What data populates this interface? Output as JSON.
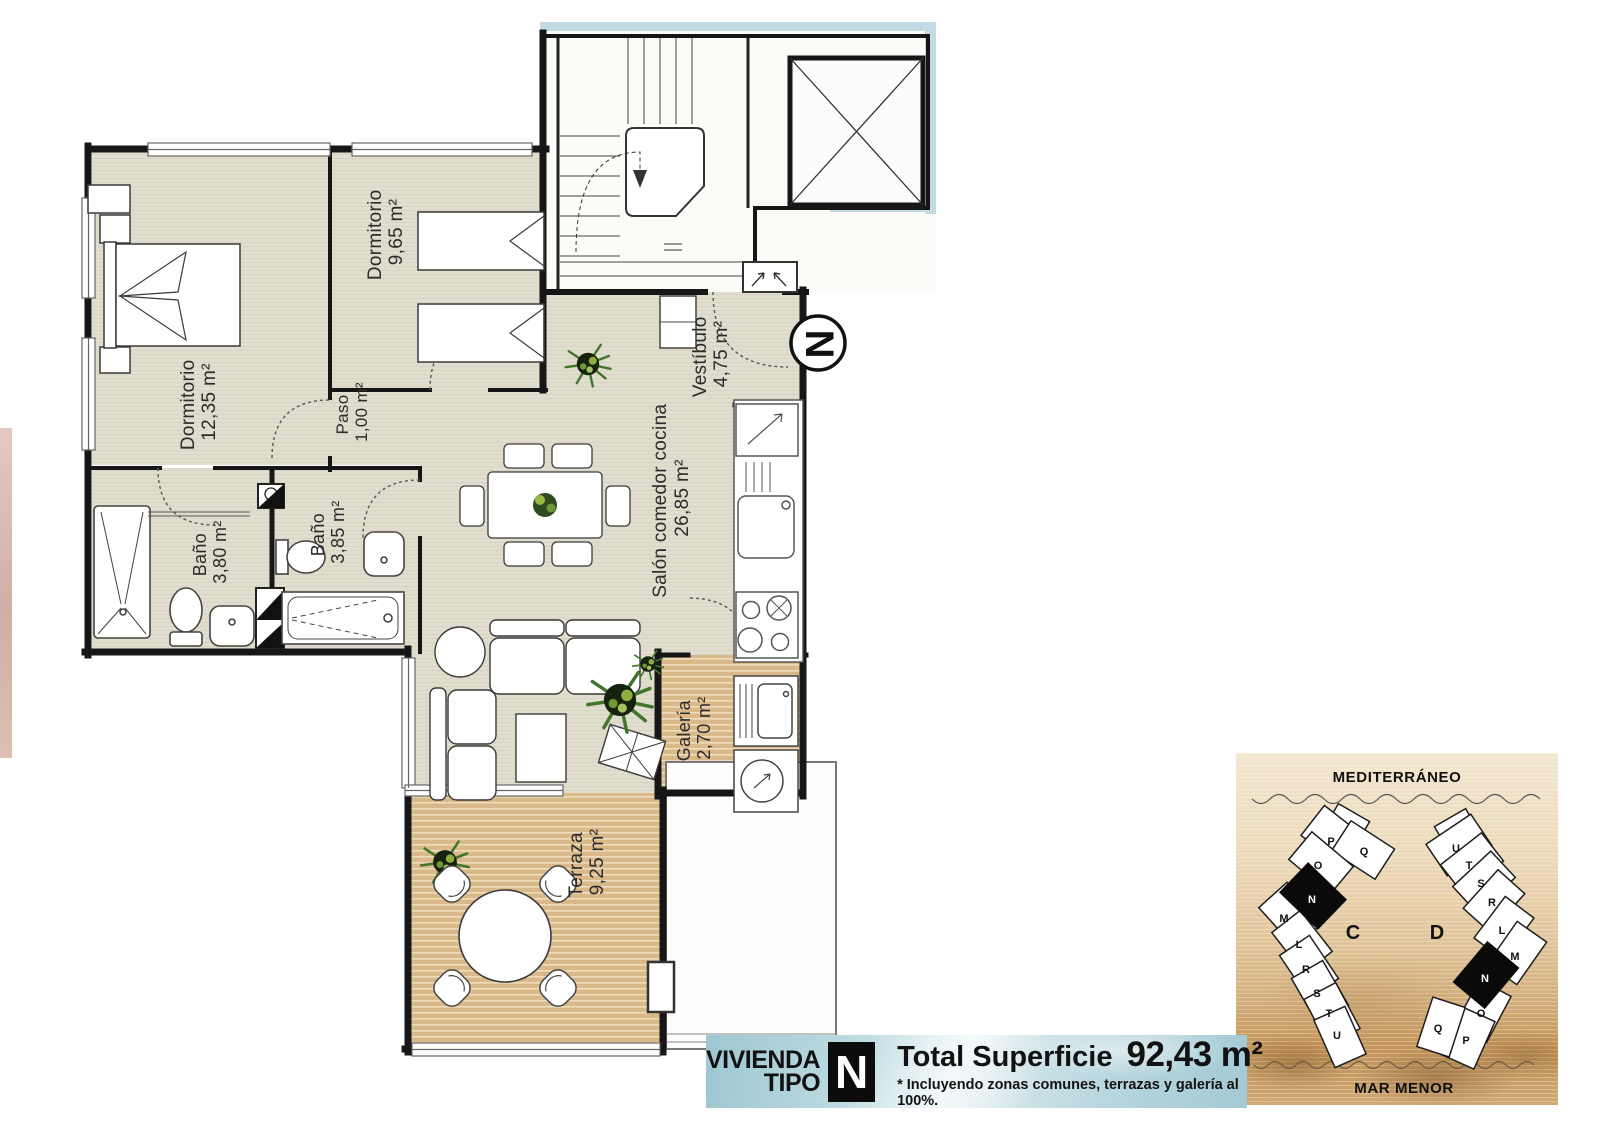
{
  "plan": {
    "north": "N",
    "rooms": {
      "dormitorio1": {
        "name": "Dormitorio",
        "area": "12,35 m²"
      },
      "dormitorio2": {
        "name": "Dormitorio",
        "area": "9,65 m²"
      },
      "paso": {
        "name": "Paso",
        "area": "1,00 m²"
      },
      "bano1": {
        "name": "Baño",
        "area": "3,80 m²"
      },
      "bano2": {
        "name": "Baño",
        "area": "3,85 m²"
      },
      "vestibulo": {
        "name": "Vestíbulo",
        "area": "4,75 m²"
      },
      "salon": {
        "name": "Salón comedor cocina",
        "area": "26,85 m²"
      },
      "galeria": {
        "name": "Galería",
        "area": "2,70 m²"
      },
      "terraza": {
        "name": "Terraza",
        "area": "9,25 m²"
      }
    },
    "colors": {
      "room_floor": "#e1decf",
      "deck_floor": "#d9b88a",
      "wall": "#161616",
      "exterior_band": "#c3d9e3"
    }
  },
  "banner": {
    "title_line1": "VIVIENDA",
    "title_line2": "TIPO",
    "type_letter": "N",
    "total_label": "Total Superficie",
    "total_value": "92,43 m²",
    "footnote": "* Incluyendo zonas comunes, terrazas y galería al 100%."
  },
  "sitemap": {
    "sea_top": "MEDITERRÁNEO",
    "sea_bottom": "MAR MENOR",
    "label_c": "C",
    "label_d": "D",
    "building_c_units": [
      "P",
      "Q",
      "O",
      "N",
      "M",
      "L",
      "R",
      "S",
      "T",
      "U"
    ],
    "building_d_units": [
      "U",
      "T",
      "S",
      "R",
      "L",
      "M",
      "N",
      "O",
      "P",
      "Q"
    ]
  }
}
